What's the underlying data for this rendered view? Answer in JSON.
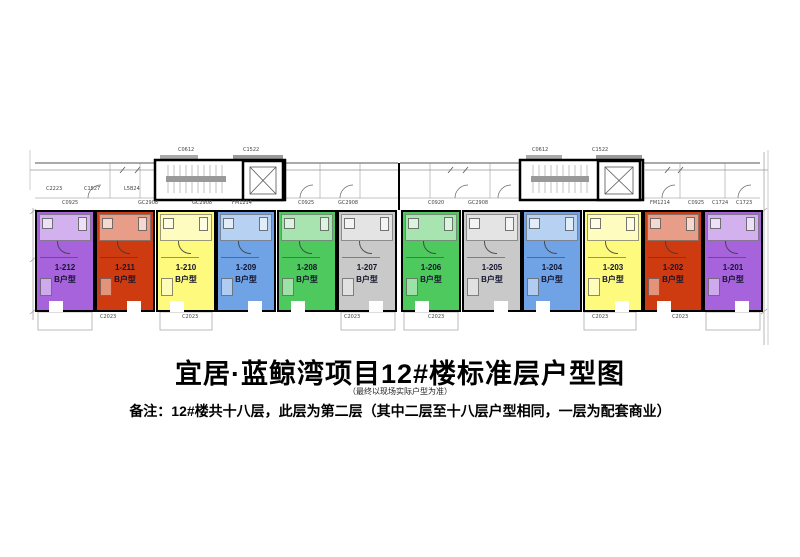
{
  "title": {
    "main": "宜居·蓝鲸湾项目12#楼标准层户型图",
    "sub": "（最终以现场实际户型为准）",
    "note": "备注：12#楼共十八层，此层为第二层（其中二层至十八层户型相同，一层为配套商业）"
  },
  "plan": {
    "units": [
      {
        "id": "1-212",
        "type": "B户型",
        "color": "#A763DC"
      },
      {
        "id": "1-211",
        "type": "B户型",
        "color": "#CE3B10"
      },
      {
        "id": "1-210",
        "type": "B户型",
        "color": "#FDFA7E"
      },
      {
        "id": "1-209",
        "type": "B户型",
        "color": "#6FA3E6"
      },
      {
        "id": "1-208",
        "type": "B户型",
        "color": "#4EC95E"
      },
      {
        "id": "1-207",
        "type": "B户型",
        "color": "#C9C9C9"
      },
      {
        "id": "1-206",
        "type": "B户型",
        "color": "#4EC95E"
      },
      {
        "id": "1-205",
        "type": "B户型",
        "color": "#C9C9C9"
      },
      {
        "id": "1-204",
        "type": "B户型",
        "color": "#6FA3E6"
      },
      {
        "id": "1-203",
        "type": "B户型",
        "color": "#FDFA7E"
      },
      {
        "id": "1-202",
        "type": "B户型",
        "color": "#CE3B10"
      },
      {
        "id": "1-201",
        "type": "B户型",
        "color": "#A763DC"
      }
    ],
    "codes": [
      "C2223",
      "C1527",
      "L5B24",
      "C0925",
      "GC2908",
      "GC2908",
      "FM1214",
      "C0925",
      "GC2908",
      "C0920",
      "GC2908",
      "FM1214",
      "C0925",
      "C1724",
      "C1723",
      "C0612",
      "C1522",
      "C0612",
      "C1522",
      "C2023",
      "C2023",
      "C2023",
      "C2023",
      "C2023",
      "C2023"
    ]
  }
}
